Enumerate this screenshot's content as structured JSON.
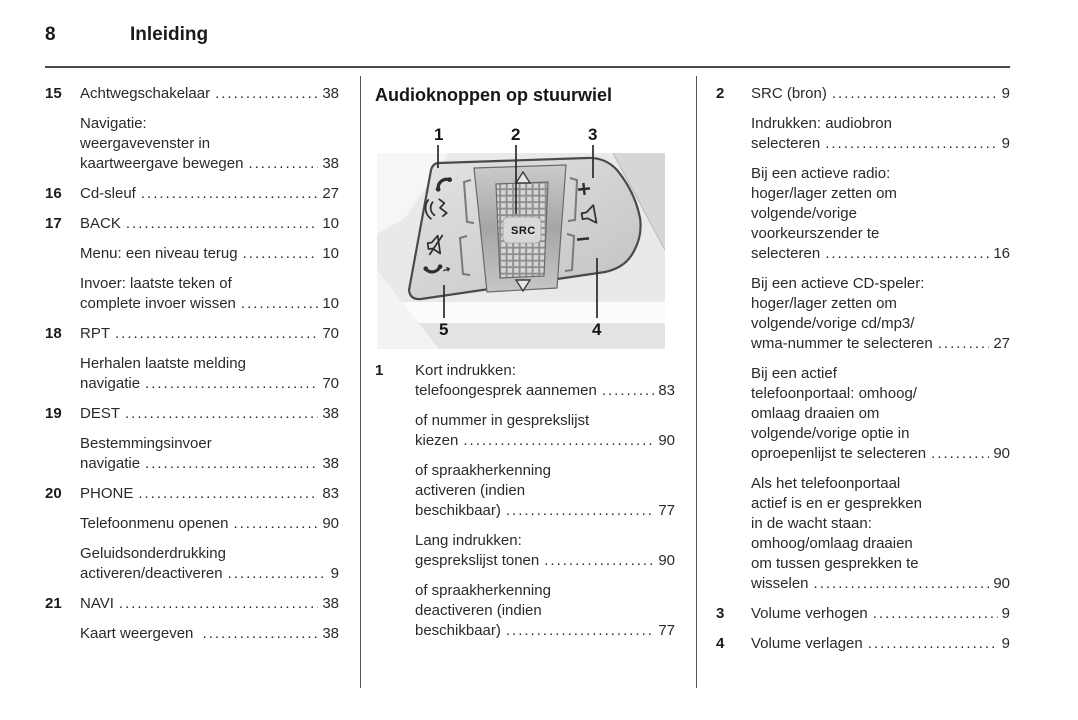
{
  "page": {
    "number": "8",
    "title": "Inleiding"
  },
  "left_column": {
    "entries": [
      {
        "num": "15",
        "lines": [
          "Achtwegschakelaar"
        ],
        "page": "38"
      },
      {
        "num": "",
        "lines": [
          "Navigatie:",
          "weergavevenster in",
          "kaartweergave bewegen"
        ],
        "page": "38"
      },
      {
        "num": "16",
        "lines": [
          "Cd-sleuf"
        ],
        "page": "27"
      },
      {
        "num": "17",
        "lines": [
          "BACK"
        ],
        "page": "10"
      },
      {
        "num": "",
        "lines": [
          "Menu: een niveau terug"
        ],
        "page": "10"
      },
      {
        "num": "",
        "lines": [
          "Invoer: laatste teken of",
          "complete invoer wissen"
        ],
        "page": "10"
      },
      {
        "num": "18",
        "lines": [
          "RPT"
        ],
        "page": "70"
      },
      {
        "num": "",
        "lines": [
          "Herhalen laatste melding",
          "navigatie"
        ],
        "page": "70"
      },
      {
        "num": "19",
        "lines": [
          "DEST"
        ],
        "page": "38"
      },
      {
        "num": "",
        "lines": [
          "Bestemmingsinvoer",
          "navigatie"
        ],
        "page": "38"
      },
      {
        "num": "20",
        "lines": [
          "PHONE"
        ],
        "page": "83"
      },
      {
        "num": "",
        "lines": [
          "Telefoonmenu openen"
        ],
        "page": "90"
      },
      {
        "num": "",
        "lines": [
          "Geluidsonderdrukking",
          "activeren/deactiveren"
        ],
        "page": "9"
      },
      {
        "num": "21",
        "lines": [
          "NAVI"
        ],
        "page": "38"
      },
      {
        "num": "",
        "lines": [
          "Kaart weergeven "
        ],
        "page": "38"
      }
    ]
  },
  "middle_column": {
    "heading": "Audioknoppen op stuurwiel",
    "figure": {
      "callout_1": "1",
      "callout_2": "2",
      "callout_3": "3",
      "callout_4": "4",
      "callout_5": "5",
      "wheel_label": "SRC",
      "volume_plus_label": "+",
      "volume_minus_label": "−"
    },
    "entries": [
      {
        "num": "1",
        "lines": [
          "Kort indrukken:",
          "telefoongesprek aannemen"
        ],
        "page": "83"
      },
      {
        "num": "",
        "lines": [
          "of nummer in gesprekslijst",
          "kiezen"
        ],
        "page": "90"
      },
      {
        "num": "",
        "lines": [
          "of spraakherkenning",
          "activeren (indien",
          "beschikbaar)"
        ],
        "page": "77"
      },
      {
        "num": "",
        "lines": [
          "Lang indrukken:",
          "gesprekslijst tonen"
        ],
        "page": "90"
      },
      {
        "num": "",
        "lines": [
          "of spraakherkenning",
          "deactiveren (indien",
          "beschikbaar)"
        ],
        "page": "77"
      }
    ]
  },
  "right_column": {
    "entries": [
      {
        "num": "2",
        "lines": [
          "SRC (bron)"
        ],
        "page": "9"
      },
      {
        "num": "",
        "lines": [
          "Indrukken: audiobron",
          "selecteren"
        ],
        "page": "9"
      },
      {
        "num": "",
        "lines": [
          "Bij een actieve radio:",
          "hoger/lager zetten om",
          "volgende/vorige",
          "voorkeurszender te",
          "selecteren"
        ],
        "page": "16"
      },
      {
        "num": "",
        "lines": [
          "Bij een actieve CD-speler:",
          "hoger/lager zetten om",
          "volgende/vorige cd/mp3/",
          "wma-nummer te selecteren"
        ],
        "page": "27"
      },
      {
        "num": "",
        "lines": [
          "Bij een actief",
          "telefoonportaal: omhoog/",
          "omlaag draaien om",
          "volgende/vorige optie in",
          "oproepenlijst te selecteren"
        ],
        "page": "90"
      },
      {
        "num": "",
        "lines": [
          "Als het telefoonportaal",
          "actief is en er gesprekken",
          "in de wacht staan:",
          "omhoog/omlaag draaien",
          "om tussen gesprekken te",
          "wisselen"
        ],
        "page": "90"
      },
      {
        "num": "3",
        "lines": [
          "Volume verhogen"
        ],
        "page": "9"
      },
      {
        "num": "4",
        "lines": [
          "Volume verlagen"
        ],
        "page": "9"
      }
    ]
  }
}
